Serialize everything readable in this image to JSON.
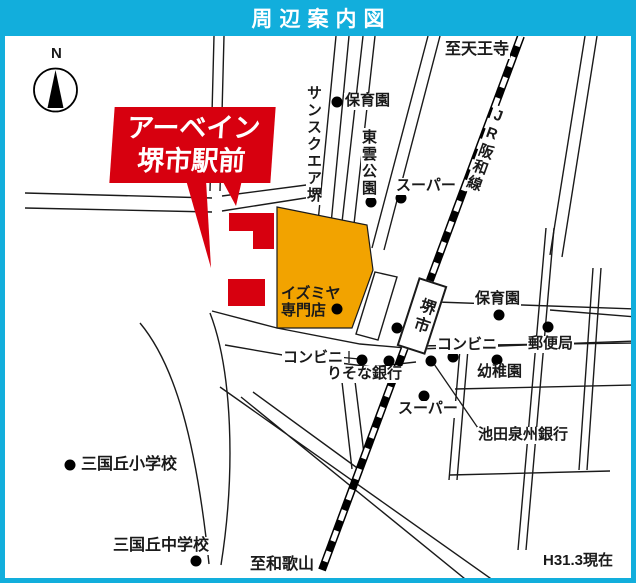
{
  "colors": {
    "accent_cyan": "#12AEDC",
    "brand_red": "#D7000F",
    "landmark_orange": "#F2A300",
    "ink": "#1a1a1a"
  },
  "title_bar": {
    "title": "周辺案内図"
  },
  "map": {
    "compass": {
      "label": "N"
    },
    "property_banner": {
      "line1": "アーベイン",
      "line2": "堺市駅前"
    },
    "station": {
      "label": "堺市"
    },
    "landmark_area": {
      "line1": "イズミヤ",
      "line2": "専門店"
    },
    "note": "H31.3現在",
    "labels": [
      {
        "id": "compass-n",
        "text": "N",
        "x": 50,
        "y": 46,
        "size": 15
      },
      {
        "id": "to-tennoji",
        "text": "至天王寺",
        "x": 444,
        "y": 41,
        "size": 16
      },
      {
        "id": "jr-hanwa-line",
        "text": "JR阪和線",
        "x": 494,
        "y": 107,
        "vertical": true,
        "rotate": 20,
        "size": 15
      },
      {
        "id": "hoikuen-top",
        "text": "保育園",
        "x": 344,
        "y": 93
      },
      {
        "id": "sunsquare-sakai",
        "text": "サンスクエア堺",
        "x": 306,
        "y": 84,
        "vertical": true
      },
      {
        "id": "shinonome-park",
        "text": "東雲公園",
        "x": 361,
        "y": 128,
        "vertical": true
      },
      {
        "id": "super-top",
        "text": "スーパー",
        "x": 395,
        "y": 178
      },
      {
        "id": "izumiya-senmonten",
        "text": "イズミヤ\n専門店",
        "x": 280,
        "y": 286,
        "bg": false
      },
      {
        "id": "hoikuen-right",
        "text": "保育園",
        "x": 474,
        "y": 291
      },
      {
        "id": "yubinkyoku",
        "text": "郵便局",
        "x": 527,
        "y": 336
      },
      {
        "id": "conbini-right",
        "text": "コンビニ",
        "x": 436,
        "y": 337
      },
      {
        "id": "youchien",
        "text": "幼稚園",
        "x": 476,
        "y": 364
      },
      {
        "id": "conbini-left",
        "text": "コンビニ",
        "x": 282,
        "y": 350
      },
      {
        "id": "risona-bank",
        "text": "りそな銀行",
        "x": 326,
        "y": 366
      },
      {
        "id": "super-lower",
        "text": "スーパー",
        "x": 397,
        "y": 401
      },
      {
        "id": "ikeda-senshu-bank",
        "text": "池田泉州銀行",
        "x": 477,
        "y": 427
      },
      {
        "id": "mikunigaoka-elementary",
        "text": "三国丘小学校",
        "x": 80,
        "y": 456,
        "size": 16
      },
      {
        "id": "mikunigaoka-junior-high",
        "text": "三国丘中学校",
        "x": 112,
        "y": 537,
        "size": 16
      },
      {
        "id": "to-wakayama",
        "text": "至和歌山",
        "x": 249,
        "y": 556,
        "size": 16
      },
      {
        "id": "map-note",
        "text": "H31.3現在",
        "x": 542,
        "y": 553,
        "size": 15
      }
    ],
    "dots": [
      {
        "id": "hoikuen-top-dot",
        "x": 337,
        "y": 102
      },
      {
        "id": "sunsquare-dot",
        "x": 316,
        "y": 193
      },
      {
        "id": "shinonome-dot",
        "x": 371,
        "y": 202
      },
      {
        "id": "super-top-dot",
        "x": 401,
        "y": 198
      },
      {
        "id": "izumiya-dot",
        "x": 337,
        "y": 309
      },
      {
        "id": "station-front-dot",
        "x": 397,
        "y": 328
      },
      {
        "id": "hoikuen-right-dot",
        "x": 499,
        "y": 315
      },
      {
        "id": "yubinkyoku-dot",
        "x": 548,
        "y": 327
      },
      {
        "id": "conbini-right-dot",
        "x": 453,
        "y": 357
      },
      {
        "id": "ikeda-bank-dot",
        "x": 431,
        "y": 361
      },
      {
        "id": "conbini-left-dot",
        "x": 362,
        "y": 360
      },
      {
        "id": "risona-dot",
        "x": 389,
        "y": 361
      },
      {
        "id": "youchien-dot",
        "x": 497,
        "y": 360
      },
      {
        "id": "super-lower-dot",
        "x": 424,
        "y": 396
      },
      {
        "id": "elementary-dot",
        "x": 70,
        "y": 465
      },
      {
        "id": "junior-high-dot",
        "x": 196,
        "y": 561
      }
    ],
    "leader_lines": [
      {
        "id": "ikeda-bank-leader",
        "x1": 480,
        "y1": 431,
        "x2": 434,
        "y2": 364
      },
      {
        "id": "conbini-left-leader",
        "x1": 338,
        "y1": 357,
        "x2": 359,
        "y2": 359
      },
      {
        "id": "conbini-left-tick",
        "x1": 349,
        "y1": 351,
        "x2": 349,
        "y2": 363
      }
    ]
  }
}
